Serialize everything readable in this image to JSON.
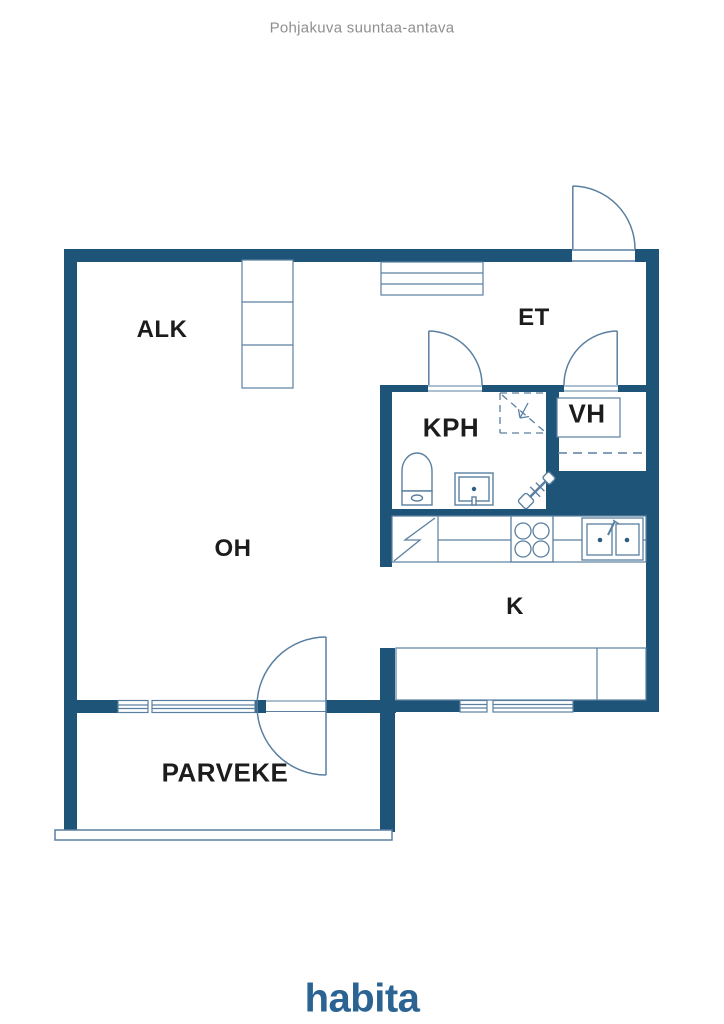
{
  "header": {
    "disclaimer": "Pohjakuva suuntaa-antava"
  },
  "plan": {
    "rooms": {
      "alk": "ALK",
      "et": "ET",
      "kph": "KPH",
      "vh": "VH",
      "oh": "OH",
      "k": "K",
      "parveke": "PARVEKE"
    },
    "fixtures": [
      "entrance-door-swing",
      "kph-door-swing",
      "vh-door-swing",
      "balcony-door-swing",
      "alk-wardrobe",
      "et-coat-rack",
      "vh-shelf",
      "shower-area",
      "toilet",
      "bathroom-sink",
      "washer-tap",
      "fridge",
      "stove",
      "kitchen-sink",
      "kitchen-counter",
      "kitchen-island",
      "windows",
      "balcony-railing"
    ],
    "colors": {
      "wall": "#1d5478",
      "line": "#5a7fa0",
      "label": "#1c1c1c"
    }
  },
  "footer": {
    "logo_text": "habita",
    "logo_color": "#2b6493"
  }
}
